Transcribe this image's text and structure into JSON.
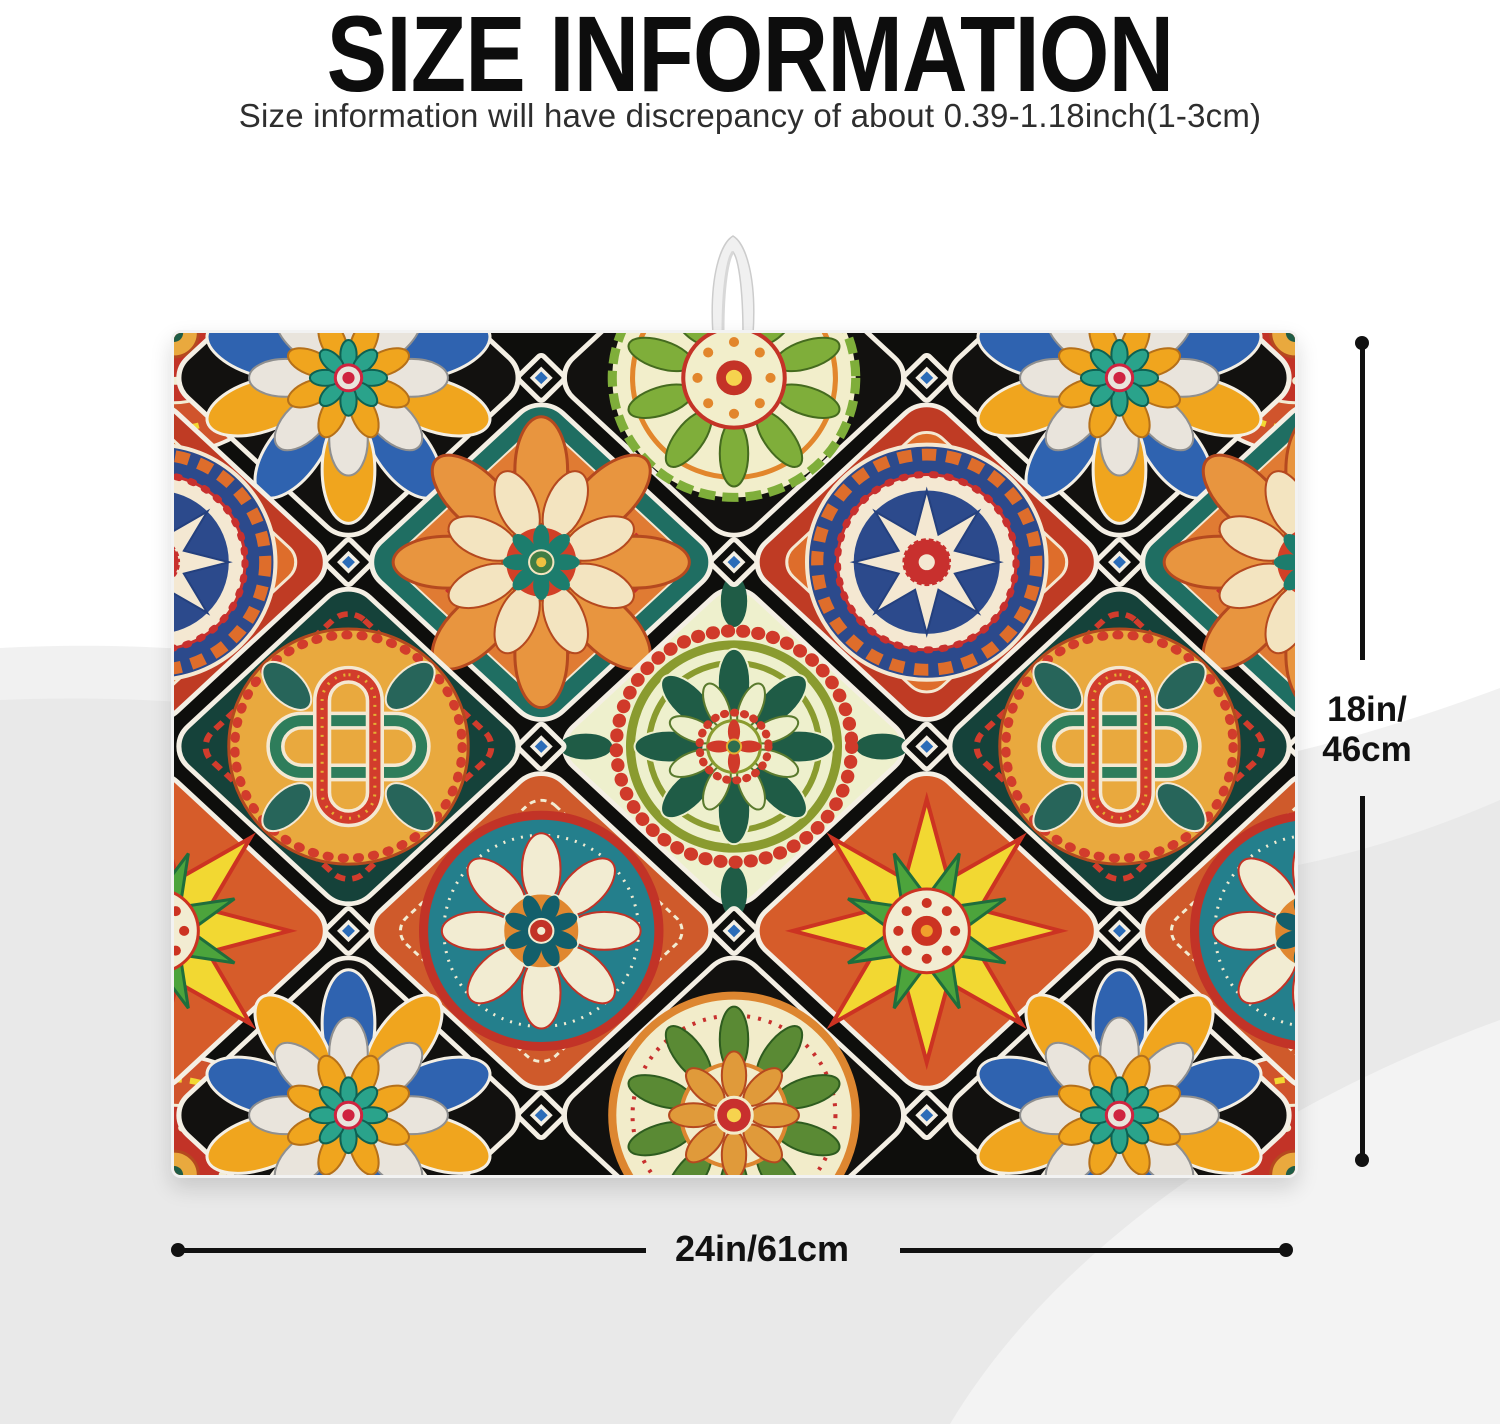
{
  "header": {
    "title": "SIZE INFORMATION",
    "subtitle": "Size information will have discrepancy of about 0.39-1.18inch(1-3cm)"
  },
  "product": {
    "description": "mandala patchwork dish drying mat with hanging loop",
    "icons": [
      "hanging-loop"
    ]
  },
  "dimensions": {
    "height": {
      "line1": "18in/",
      "line2": "46cm"
    },
    "width": {
      "label": "24in/61cm"
    },
    "line_color": "#111111"
  },
  "palette": {
    "background": "#ffffff",
    "wave_gray_light": "#f1f1f1",
    "wave_gray": "#e9e9e9",
    "mat_black": "#0e0e0c",
    "tile_outline_white": "#f4efe4",
    "orange": "#e07b33",
    "red": "#c8302e",
    "navy": "#2c4a8c",
    "blue": "#2f63b0",
    "teal": "#247f8c",
    "green": "#7fae3a",
    "dark_green": "#1f5c46",
    "yellow": "#f2d832",
    "gold": "#e9a93e",
    "cream": "#f2ecca"
  }
}
